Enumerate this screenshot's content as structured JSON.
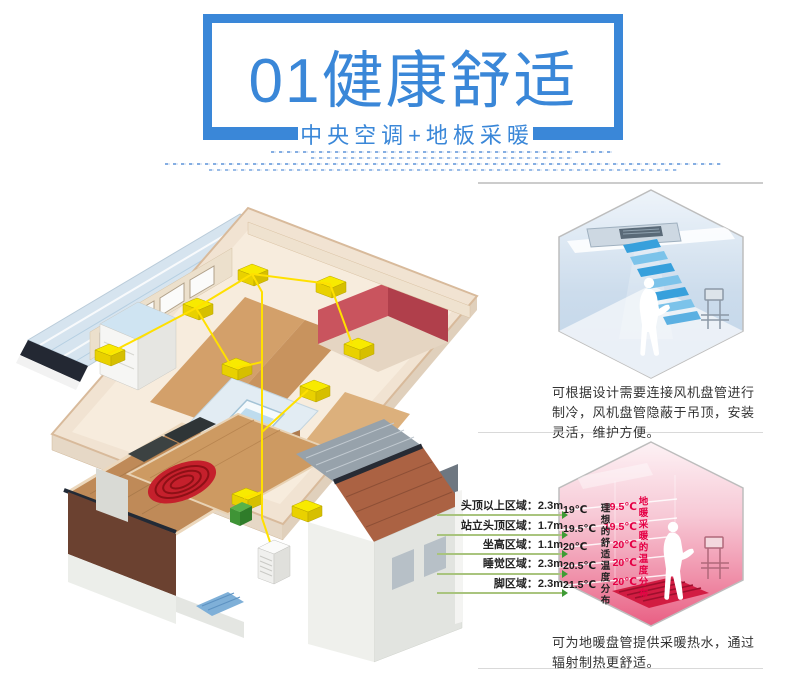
{
  "colors": {
    "accent": "#3a87d8",
    "caption_text": "#333333",
    "ideal_temp_text": "#1a1a1a",
    "floor_temp_text": "#e50045",
    "zone_arrow_green": "#3f9b35",
    "hex_border_gray": "#bdbdbd",
    "cool_hex_blue": "#bfd4e8",
    "warm_hex_pink": "#ea6488"
  },
  "header": {
    "title": "01健康舒适",
    "subtitle": "中央空调+地板采暖"
  },
  "fan_coil": {
    "caption": "可根据设计需要连接风机盘管进行制冷，风机盘管隐蔽于吊顶，安装灵活，维护方便。"
  },
  "floor_heating": {
    "caption": "可为地暖盘管提供采暖热水，通过辐射制热更舒适。",
    "zones": [
      {
        "label": "头顶以上区域：2.3m"
      },
      {
        "label": "站立头顶区域：1.7m"
      },
      {
        "label": "坐高区域：1.1m"
      },
      {
        "label": "睡觉区域：2.3m"
      },
      {
        "label": "脚区域：2.3m"
      }
    ],
    "ideal_axis_label": "理想的舒适温度分布",
    "floor_axis_label": "地暖采暖的温度分布",
    "ideal_temps": [
      "19℃",
      "19.5℃",
      "20℃",
      "20.5℃",
      "21.5℃"
    ],
    "floor_temps": [
      "19.5℃",
      "19.5℃",
      "20℃",
      "20℃",
      "20℃"
    ]
  },
  "icons": {
    "person_silhouette": "person-silhouette",
    "radiator": "radiator",
    "fan_coil_unit": "fan-coil-unit",
    "outdoor_unit": "outdoor-ac-unit"
  }
}
